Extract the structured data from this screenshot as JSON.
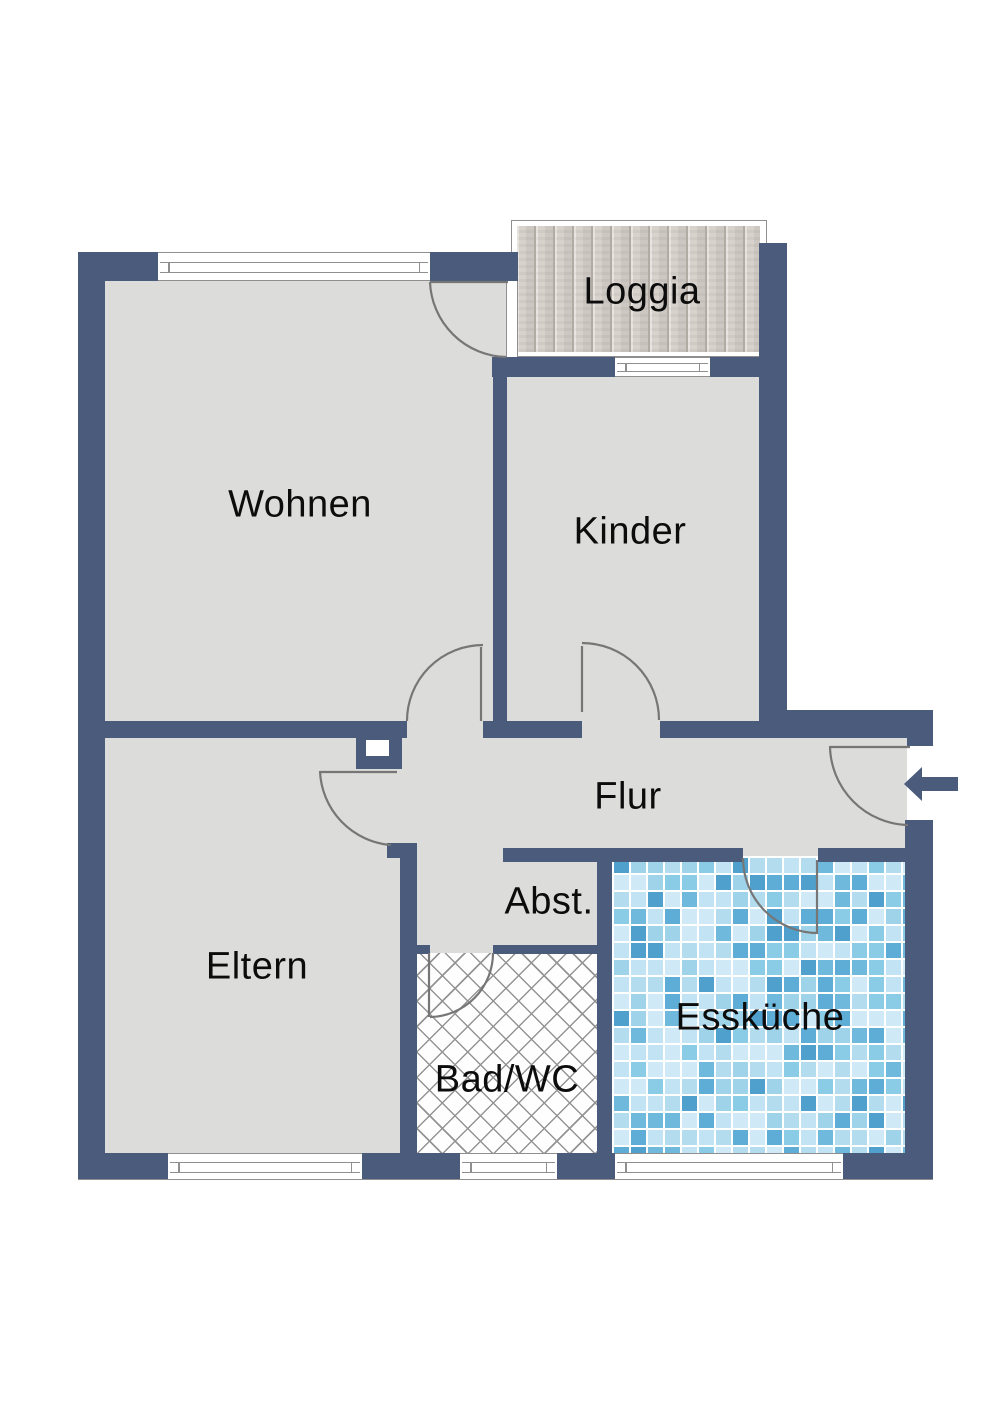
{
  "rooms": {
    "wohnen": {
      "label": "Wohnen",
      "floor": "plain"
    },
    "kinder": {
      "label": "Kinder",
      "floor": "plain"
    },
    "loggia": {
      "label": "Loggia",
      "floor": "wood-planks"
    },
    "flur": {
      "label": "Flur",
      "floor": "plain"
    },
    "abstellraum": {
      "label": "Abst.",
      "floor": "plain"
    },
    "eltern": {
      "label": "Eltern",
      "floor": "plain"
    },
    "bad_wc": {
      "label": "Bad/WC",
      "floor": "crosshatch-tile"
    },
    "esskueche": {
      "label": "Essküche",
      "floor": "blue-mosaic-tile"
    }
  },
  "entrance": {
    "arrow_direction": "left"
  },
  "colors": {
    "wall": "#4a5b7c",
    "room_fill": "#dcdcda",
    "outline": "#8f8f8f",
    "door_line": "#767676",
    "wood_base": "#d6d0ca",
    "wood_line": "#b2aba4",
    "crosshatch_line": "#949494",
    "tile_grout": "#ffffff"
  },
  "kitchen_tiles": {
    "palette": [
      "#cfe9f7",
      "#c2e3f3",
      "#b3dcef",
      "#9fd3ea",
      "#8accе5",
      "#6fb9dc",
      "#5dadd6",
      "#4fa0cc"
    ],
    "palette_safe": [
      "#cfe9f7",
      "#c2e3f3",
      "#b3dcef",
      "#9fd3ea",
      "#8acce5",
      "#6fb9dc",
      "#5dadd6",
      "#4fa0cc"
    ]
  }
}
